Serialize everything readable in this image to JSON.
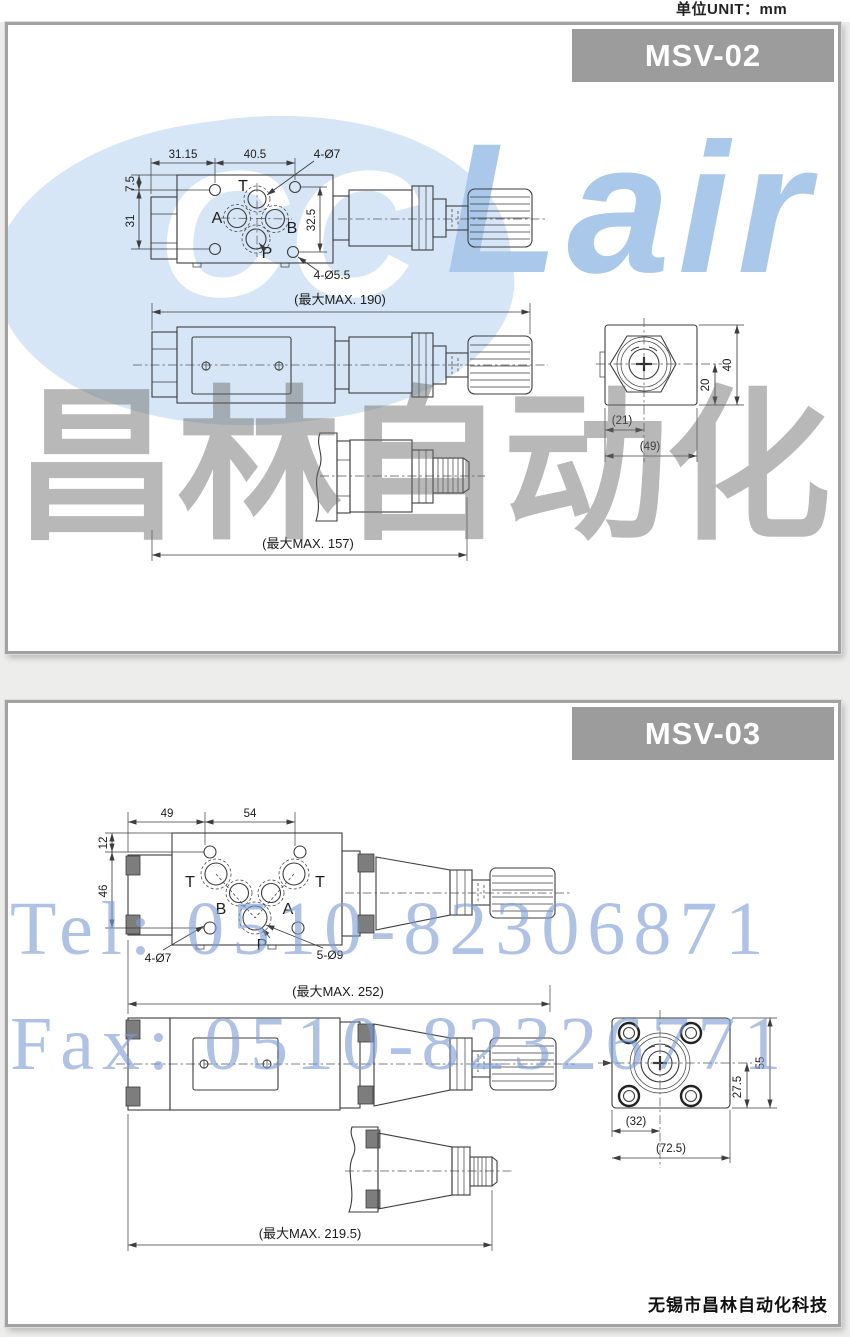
{
  "page": {
    "unit": "单位UNIT：mm"
  },
  "watermark": {
    "logo_cc": "CC",
    "logo_air": "Lair",
    "brand": "昌林自动化",
    "tel": "Tel: 0510-82306871",
    "fax": "Fax: 0510-82326771"
  },
  "footer": {
    "company": "无锡市昌林自动化科技"
  },
  "colors": {
    "title_bar": "#9c9c9c",
    "line": "#3d3d3d",
    "watermark_blue": "#cfe2f5",
    "watermark_text_blue": "#a9c8ea",
    "watermark_gray": "#6a6a6a"
  },
  "msv02": {
    "title": "MSV-02",
    "top_view": {
      "dim_w1": "31.15",
      "dim_w2": "40.5",
      "bolt_note": "4-Ø7",
      "dim_h1": "7.5",
      "dim_h2": "31",
      "dim_h3": "32.5",
      "bolt_note2": "4-Ø5.5",
      "ports": {
        "t": "T",
        "a": "A",
        "b": "B",
        "p": "P"
      }
    },
    "side_view": {
      "max_length": "(最大MAX. 190)",
      "handle_length": "(最大MAX. 157)"
    },
    "end_view": {
      "dim_w1": "(21)",
      "dim_w2": "(49)",
      "dim_h1": "20",
      "dim_h2": "40"
    }
  },
  "msv03": {
    "title": "MSV-03",
    "top_view": {
      "dim_w1": "49",
      "dim_w2": "54",
      "dim_h1": "12",
      "dim_h2": "46",
      "bolt_note": "4-Ø7",
      "bolt_note2": "5-Ø9",
      "ports": {
        "t1": "T",
        "b": "B",
        "a": "A",
        "t2": "T",
        "p": "P"
      }
    },
    "side_view": {
      "max_length": "(最大MAX. 252)",
      "handle_length": "(最大MAX. 219.5)"
    },
    "end_view": {
      "dim_w1": "(32)",
      "dim_w2": "(72.5)",
      "dim_h1": "27.5",
      "dim_h2": "55"
    }
  }
}
